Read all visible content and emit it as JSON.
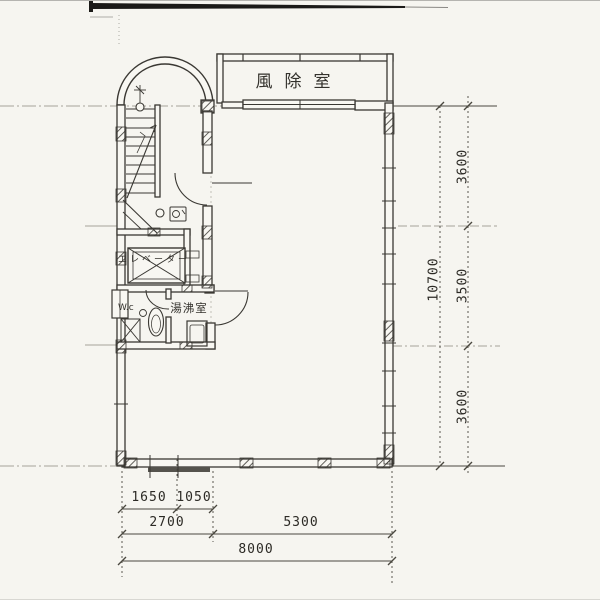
{
  "document": {
    "type": "architectural-floor-plan",
    "style": "scanned-pencil-drawing"
  },
  "labels": {
    "vestibule": "風除室",
    "elevator": "エレベーター",
    "toilet": "W.c",
    "kitchenette": "湯沸室"
  },
  "dimensions": {
    "right": {
      "overall": "10700",
      "segments": [
        "3600",
        "3500",
        "3600"
      ]
    },
    "bottom": {
      "upper": [
        "1650",
        "1050"
      ],
      "mid": [
        "2700",
        "5300"
      ],
      "overall": "8000"
    }
  },
  "colors": {
    "paper": "#f6f5f0",
    "ink": "#3a3833",
    "dim_text": "#2c2a25"
  }
}
